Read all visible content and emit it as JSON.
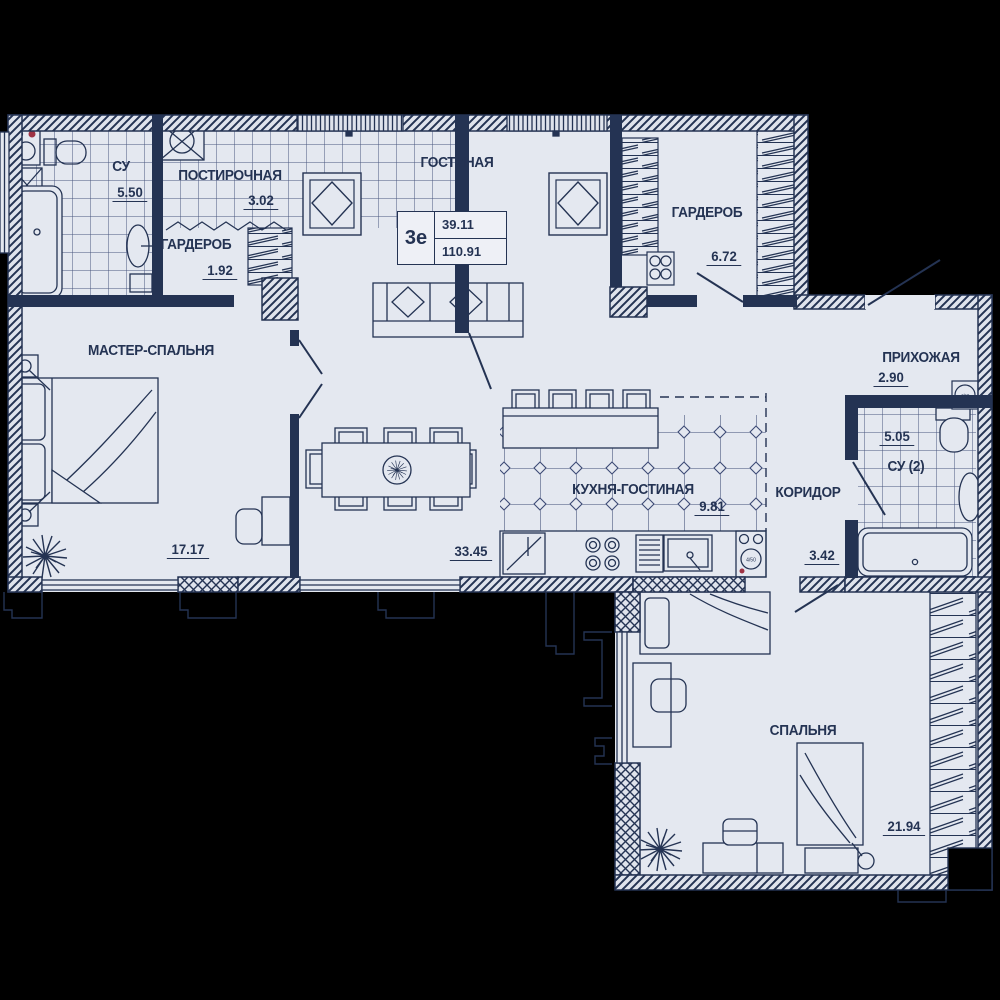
{
  "meta": {
    "background_color": "#000000",
    "floor_color": "#e4e8f0",
    "line_color": "#243353",
    "accent_color": "#9e3344"
  },
  "stamp": {
    "unit_type": "3е",
    "living_area": "39.11",
    "total_area": "110.91"
  },
  "rooms": {
    "living": {
      "name": "ГОСТИНАЯ"
    },
    "master": {
      "name": "МАСТЕР-СПАЛЬНЯ",
      "area": "17.17"
    },
    "bedroom": {
      "name": "СПАЛЬНЯ",
      "area": "21.94"
    },
    "kitchen": {
      "name": "КУХНЯ-ГОСТИНАЯ",
      "area": "9.81"
    },
    "living_kitchen": {
      "area": "33.45"
    },
    "bath1": {
      "name": "СУ",
      "area": "5.50"
    },
    "laundry": {
      "name": "ПОСТИРОЧНАЯ",
      "area": "3.02"
    },
    "wardrobe_small": {
      "name": "ГАРДЕРОБ",
      "area": "1.92"
    },
    "wardrobe_big": {
      "name": "ГАРДЕРОБ",
      "area": "6.72"
    },
    "hallway": {
      "name": "ПРИХОЖАЯ",
      "area": "2.90"
    },
    "corridor": {
      "name": "КОРИДОР",
      "area": "3.42"
    },
    "bath2": {
      "name": "СУ (2)",
      "area": "5.05"
    }
  },
  "appliances": {
    "water_heater_label": "4/50"
  }
}
